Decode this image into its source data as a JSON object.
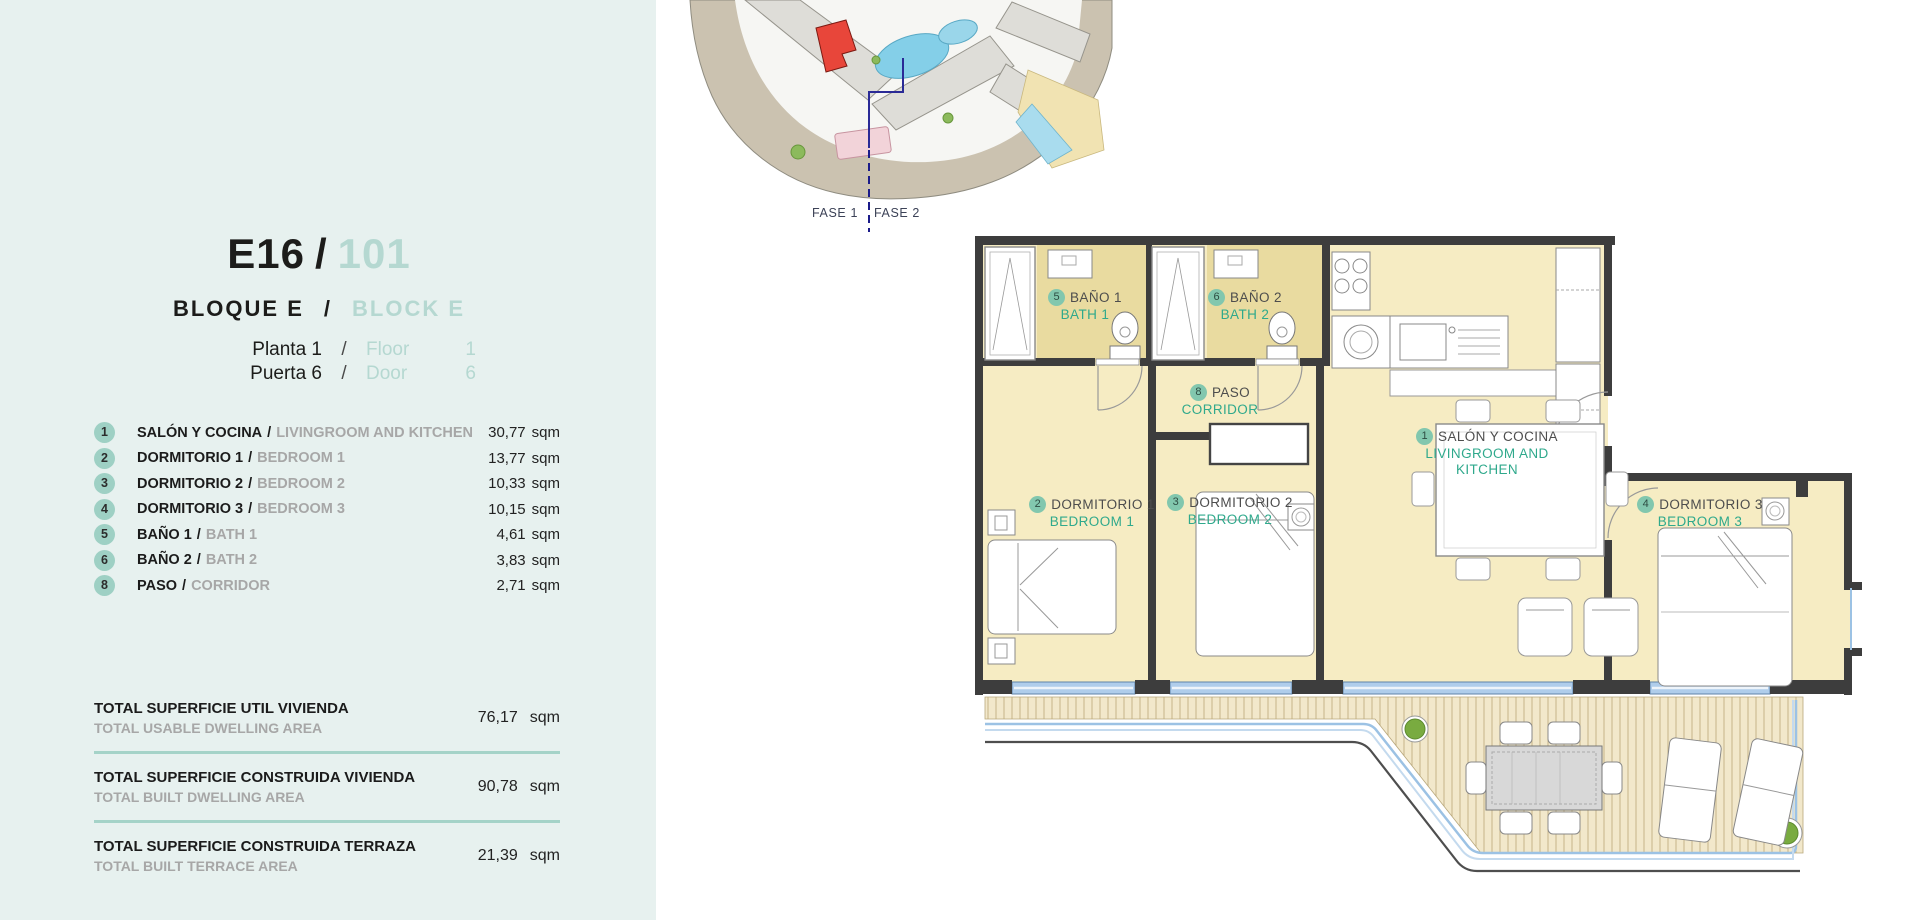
{
  "sep": "/",
  "header": {
    "code": "E16",
    "unit_number": "101",
    "block_es": "BLOQUE E",
    "block_en": "BLOCK E",
    "floor_es": "Planta 1",
    "floor_en": "Floor",
    "floor_num": "1",
    "door_es": "Puerta 6",
    "door_en": "Door",
    "door_num": "6"
  },
  "rooms": [
    {
      "num": "1",
      "es": "SALÓN Y COCINA",
      "en": "LIVINGROOM AND KITCHEN",
      "area": "30,77",
      "unit": "sqm"
    },
    {
      "num": "2",
      "es": "DORMITORIO 1",
      "en": "BEDROOM 1",
      "area": "13,77",
      "unit": "sqm"
    },
    {
      "num": "3",
      "es": "DORMITORIO 2",
      "en": "BEDROOM 2",
      "area": "10,33",
      "unit": "sqm"
    },
    {
      "num": "4",
      "es": "DORMITORIO 3",
      "en": "BEDROOM 3",
      "area": "10,15",
      "unit": "sqm"
    },
    {
      "num": "5",
      "es": "BAÑO 1",
      "en": "BATH 1",
      "area": "4,61",
      "unit": "sqm"
    },
    {
      "num": "6",
      "es": "BAÑO 2",
      "en": "BATH 2",
      "area": "3,83",
      "unit": "sqm"
    },
    {
      "num": "8",
      "es": "PASO",
      "en": "CORRIDOR",
      "area": "2,71",
      "unit": "sqm"
    }
  ],
  "totals": [
    {
      "es": "TOTAL SUPERFICIE UTIL VIVIENDA",
      "en": "TOTAL USABLE DWELLING AREA",
      "value": "76,17",
      "unit": "sqm"
    },
    {
      "es": "TOTAL SUPERFICIE CONSTRUIDA VIVIENDA",
      "en": "TOTAL BUILT DWELLING AREA",
      "value": "90,78",
      "unit": "sqm"
    },
    {
      "es": "TOTAL SUPERFICIE CONSTRUIDA TERRAZA",
      "en": "TOTAL BUILT TERRACE AREA",
      "value": "21,39",
      "unit": "sqm"
    }
  ],
  "site": {
    "fase1": "FASE 1",
    "fase2": "FASE 2"
  },
  "plan": {
    "salon": {
      "num": "1",
      "es": "SALÓN Y COCINA",
      "en": "LIVINGROOM AND KITCHEN"
    },
    "dorm1": {
      "num": "2",
      "es": "DORMITORIO 1",
      "en": "BEDROOM 1"
    },
    "dorm2": {
      "num": "3",
      "es": "DORMITORIO 2",
      "en": "BEDROOM 2"
    },
    "dorm3": {
      "num": "4",
      "es": "DORMITORIO 3",
      "en": "BEDROOM 3"
    },
    "bath1": {
      "num": "5",
      "es": "BAÑO 1",
      "en": "BATH 1"
    },
    "bath2": {
      "num": "6",
      "es": "BAÑO 2",
      "en": "BATH 2"
    },
    "paso": {
      "num": "8",
      "es": "PASO",
      "en": "CORRIDOR"
    }
  },
  "colors": {
    "accent_teal": "#2fa98c",
    "pale_teal": "#b5d8d1",
    "badge_teal": "#9ed0c4",
    "panel_bg": "#e7f1ef",
    "divider": "#a5d3c8",
    "highlight_red": "#e8463a",
    "room_fill": "#f6ecc3",
    "bath_fill": "#e9dba0",
    "window_blue": "#afcdeb"
  }
}
